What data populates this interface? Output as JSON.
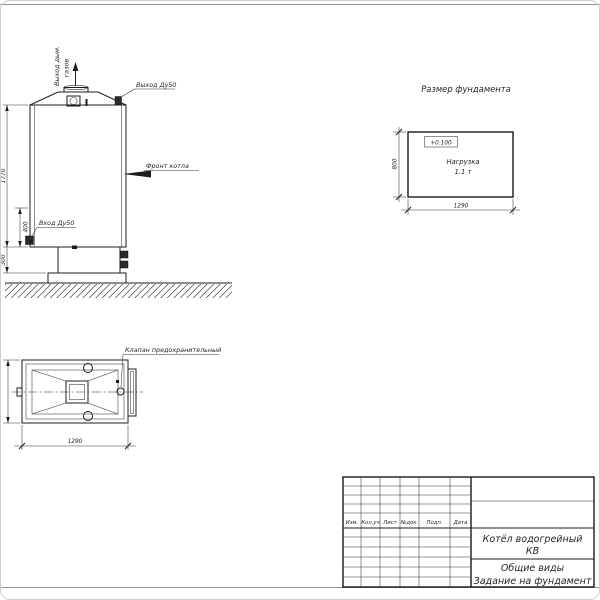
{
  "drawing": {
    "front_view": {
      "flue_label_line1": "Выход дым.",
      "flue_label_line2": "газов",
      "outlet_label": "Выход Ду50",
      "front_label": "Фронт котла",
      "inlet_label": "Вход Ду50",
      "dim_height": "1770",
      "dim_inlet": "400",
      "dim_base": "300"
    },
    "plan_view": {
      "valve_label": "Клапан предохранительный",
      "dim_length": "1290"
    },
    "foundation": {
      "title": "Размер фундамента",
      "elevation_mark": "+0.100",
      "load_line1": "Нагрузка",
      "load_line2": "1.1 т",
      "dim_width": "800",
      "dim_length": "1290"
    },
    "title_block": {
      "columns": [
        "Изм.",
        "Кол.уч",
        "Лист",
        "№док.",
        "Подп.",
        "Дата"
      ],
      "product_line1": "Котёл водогрейный",
      "product_line2": "КВ",
      "doc_line1": "Общие виды",
      "doc_line2": "Задание на фундамент"
    }
  }
}
